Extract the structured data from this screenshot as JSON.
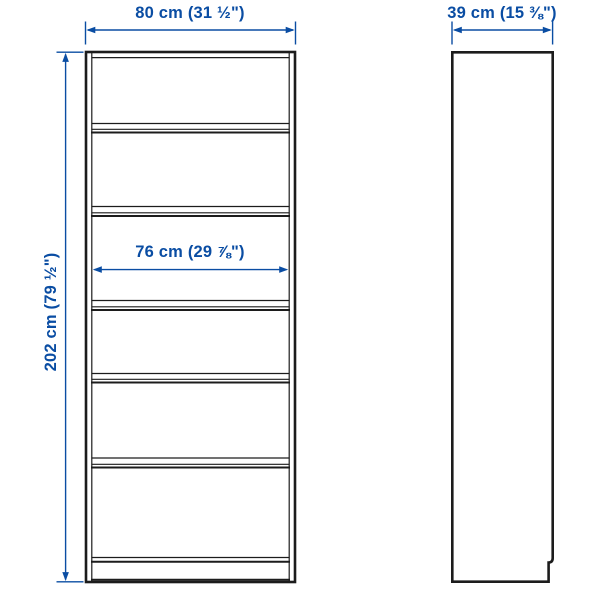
{
  "colors": {
    "background": "#ffffff",
    "furniture-line": "#1c1c1c",
    "dimension": "#0a4da3"
  },
  "diagram": {
    "labels": {
      "width": "80 cm (31 ½\")",
      "depth": "39 cm (15 ⅜\")",
      "height": "202 cm (79 ½\")",
      "interior_width": "76 cm (29 ⅞\")"
    },
    "front_view": {
      "compartments": 6
    },
    "side_view": {
      "plinth_notch": "bottom-right"
    }
  }
}
